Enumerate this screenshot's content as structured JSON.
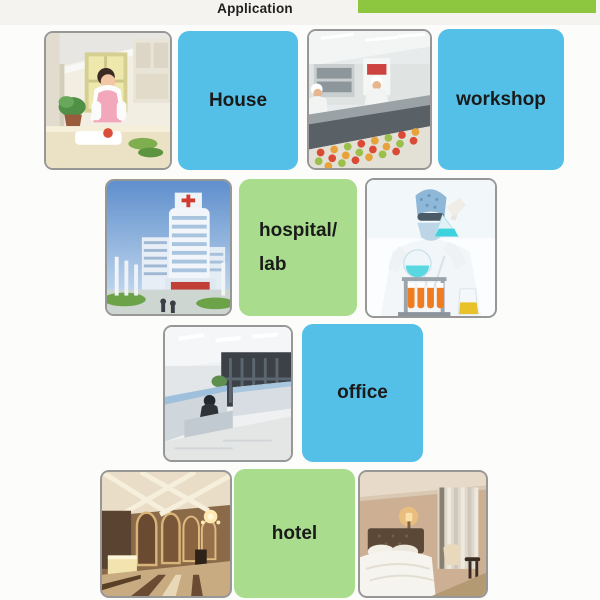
{
  "header": {
    "title": "Application",
    "accent_bar_color": "#8dc63f",
    "background": "#f4f3f0"
  },
  "colors": {
    "blue_label_bg": "#54c0e8",
    "green_label_bg": "#a9dd8d",
    "label_text": "#1a1a1a",
    "photo_border": "#979797"
  },
  "labels": {
    "house": "House",
    "workshop": "workshop",
    "hospital_line1": "hospital/",
    "hospital_line2": "lab",
    "office": "office",
    "hotel": "hotel"
  },
  "photos": {
    "house": "home-kitchen-photo",
    "workshop": "food-workshop-photo",
    "hospital": "hospital-building-photo",
    "lab": "laboratory-scientist-photo",
    "office": "office-interior-photo",
    "hotel_lobby": "hotel-lobby-photo",
    "hotel_room": "hotel-room-photo"
  }
}
